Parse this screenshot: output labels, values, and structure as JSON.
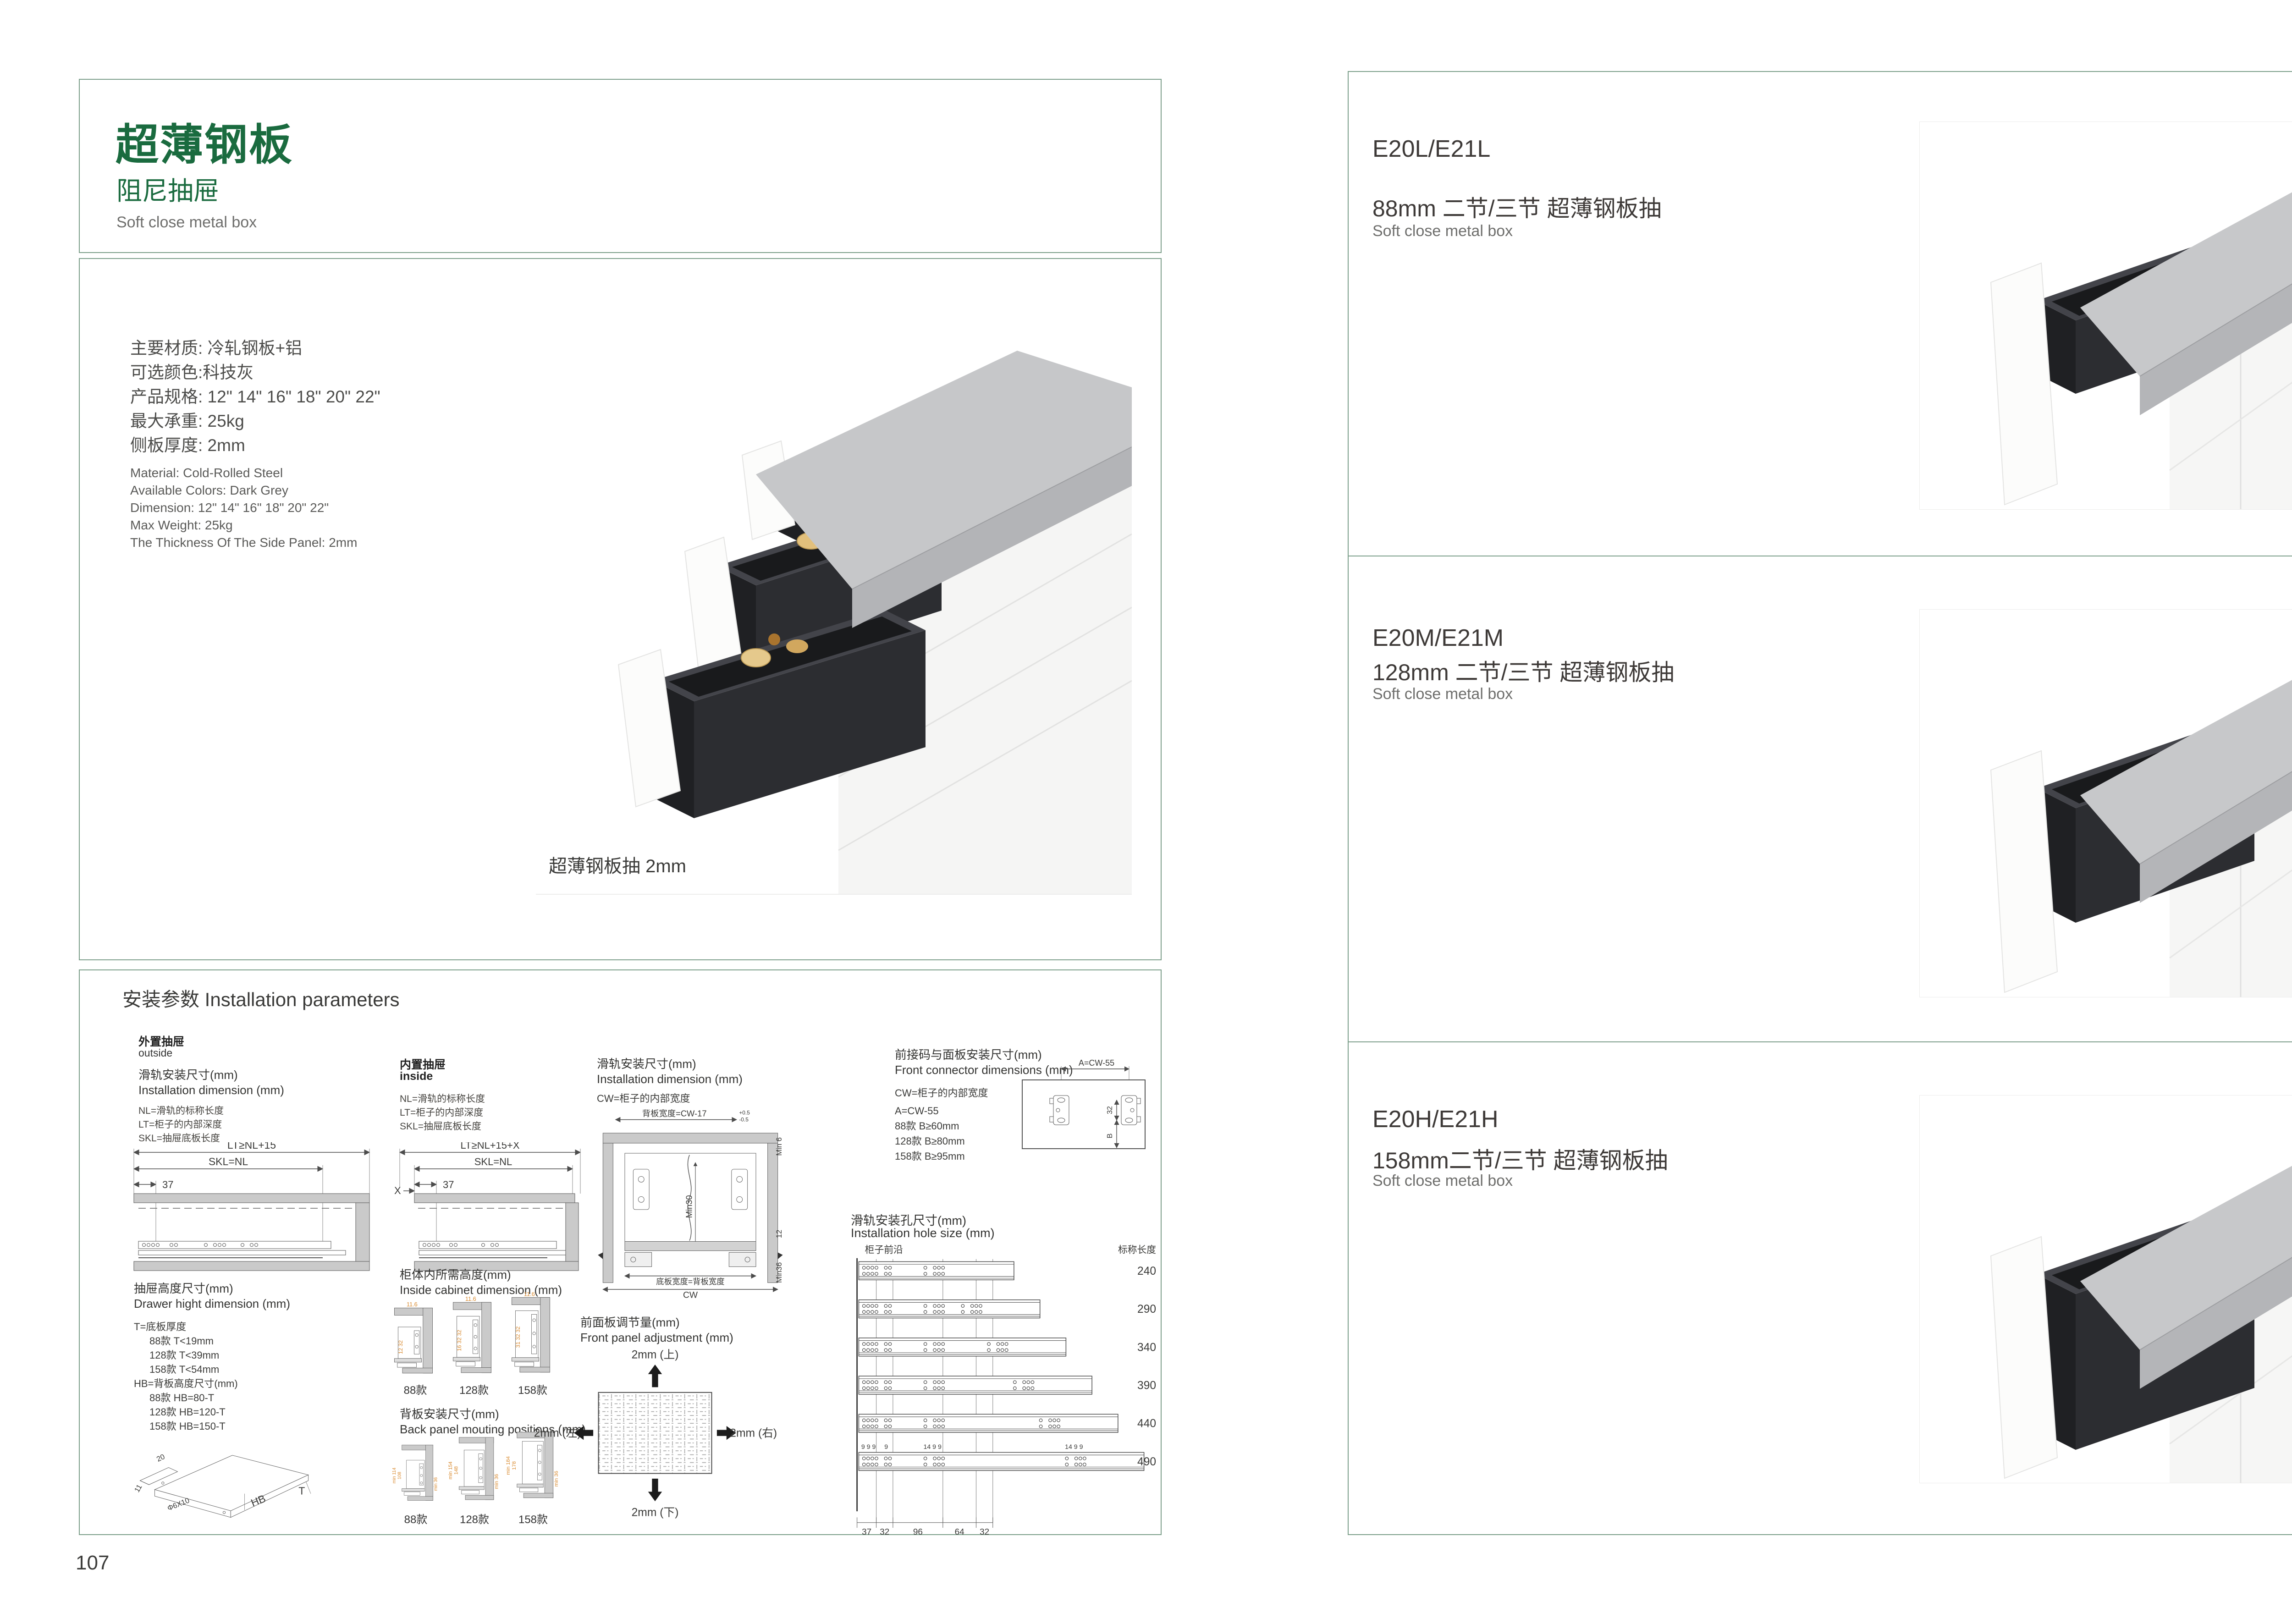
{
  "page_left": {
    "page_number": "107",
    "header": {
      "title": "超薄钢板",
      "subtitle": "阻尼抽屉",
      "tagline": "Soft close metal box"
    },
    "specs_cn": [
      "主要材质: 冷轧钢板+铝",
      "可选颜色:科技灰",
      "产品规格: 12\" 14\" 16\" 18\" 20\" 22\"",
      "最大承重: 25kg",
      "侧板厚度: 2mm"
    ],
    "specs_en": [
      "Material: Cold-Rolled Steel",
      "Available Colors: Dark Grey",
      "Dimension: 12\" 14\" 16\" 18\" 20\" 22\"",
      "Max Weight: 25kg",
      "The Thickness Of The Side Panel: 2mm"
    ],
    "photo_caption": "超薄钢板抽 2mm",
    "install": {
      "section_title": "安装参数 Installation parameters",
      "outside": {
        "tag_cn": "外置抽屉",
        "tag_en": "outside",
        "dim_title_cn": "滑轨安装尺寸(mm)",
        "dim_title_en": "Installation dimension (mm)",
        "legend": [
          "NL=滑轨的标称长度",
          "LT=柜子的内部深度",
          "SKL=抽屉底板长度"
        ],
        "dims": {
          "lt": "LT≥NL+15",
          "skl": "SKL=NL",
          "d37": "37"
        }
      },
      "inside": {
        "tag_cn": "内置抽屉",
        "tag_en": "inside",
        "legend": [
          "NL=滑轨的标称长度",
          "LT=柜子的内部深度",
          "SKL=抽屉底板长度"
        ],
        "dims": {
          "lt": "LT≥NL+15+X",
          "skl": "SKL=NL",
          "d37": "37",
          "x": "X"
        }
      },
      "width": {
        "title_cn": "滑轨安装尺寸(mm)",
        "title_en": "Installation dimension (mm)",
        "cw_note": "CW=柜子的内部宽度",
        "dims": {
          "back_w": "背板宽度=CW-17",
          "tol_up": "+0.5",
          "tol_dn": "-0.5",
          "min6": "Min 6",
          "min30": "Min30",
          "d12": "12",
          "min36": "Min36",
          "bottom_w": "底板宽度=背板宽度",
          "cw": "CW"
        }
      },
      "connector": {
        "title_cn": "前接码与面板安装尺寸(mm)",
        "title_en": "Front connector  dimensions (mm)",
        "cw_note": "CW=柜子的内部宽度",
        "lines": [
          "A=CW-55",
          "88款   B≥60mm",
          "128款  B≥80mm",
          "158款  B≥95mm"
        ],
        "dims": {
          "a": "A=CW-55",
          "d32": "32",
          "b": "B"
        }
      },
      "height": {
        "title_cn": "抽屉高度尺寸(mm)",
        "title_en": "Drawer hight dimension (mm)",
        "lines": [
          "T=底板厚度",
          "88款   T<19mm",
          "128款  T<39mm",
          "158款  T<54mm",
          "HB=背板高度尺寸(mm)",
          "88款   HB=80-T",
          "128款 HB=120-T",
          "158款 HB=150-T"
        ],
        "iso": {
          "d20": "20",
          "d11": "11",
          "hole": "Φ6X10",
          "hb": "HB",
          "t": "T"
        }
      },
      "cabinet": {
        "title_cn": "柜体内所需高度(mm)",
        "title_en": "Inside cabinet dimension (mm)",
        "variants": [
          {
            "label": "88款",
            "top": "11.6",
            "stack": "12 32"
          },
          {
            "label": "128款",
            "top": "11.6",
            "stack": "16 32 32"
          },
          {
            "label": "158款",
            "top": "11.6",
            "stack": "31 32 32"
          }
        ]
      },
      "back_panel": {
        "title_cn": "背板安装尺寸(mm)",
        "title_en": "Back panel mouting positions (mm)",
        "variants": [
          {
            "label": "88款",
            "min_h": "min 114",
            "h": "108",
            "side": "min 36"
          },
          {
            "label": "128款",
            "min_h": "min 154",
            "h": "148",
            "side": "min 36"
          },
          {
            "label": "158款",
            "min_h": "min 184",
            "h": "178",
            "side": "min 36"
          }
        ]
      },
      "adjust": {
        "title_cn": "前面板调节量(mm)",
        "title_en": "Front panel adjustment (mm)",
        "up": "2mm (上)",
        "down": "2mm (下)",
        "left": "2mm (左)",
        "right": "2mm (右)"
      },
      "holes": {
        "title_cn": "滑轨安装孔尺寸(mm)",
        "title_en": "Installation hole size (mm)",
        "front_edge": "柜子前沿",
        "length_header": "标称长度",
        "lengths": [
          240,
          290,
          340,
          390,
          440,
          490
        ],
        "bottom_dims": [
          "37",
          "32",
          "96",
          "64",
          "32"
        ],
        "top_groups": [
          "9 9 9",
          "9",
          "14 9 9",
          "14 9 9"
        ]
      }
    }
  },
  "page_right": {
    "page_number": "108",
    "products": [
      {
        "model": "E20L/E21L",
        "title_cn": "88mm 二节/三节 超薄钢板抽",
        "title_en": "Soft close metal box"
      },
      {
        "model": "E20M/E21M",
        "title_cn": "128mm 二节/三节 超薄钢板抽",
        "title_en": "Soft close metal box"
      },
      {
        "model": "E20H/E21H",
        "title_cn": "158mm二节/三节 超薄钢板抽",
        "title_en": "Soft close metal box"
      }
    ]
  }
}
